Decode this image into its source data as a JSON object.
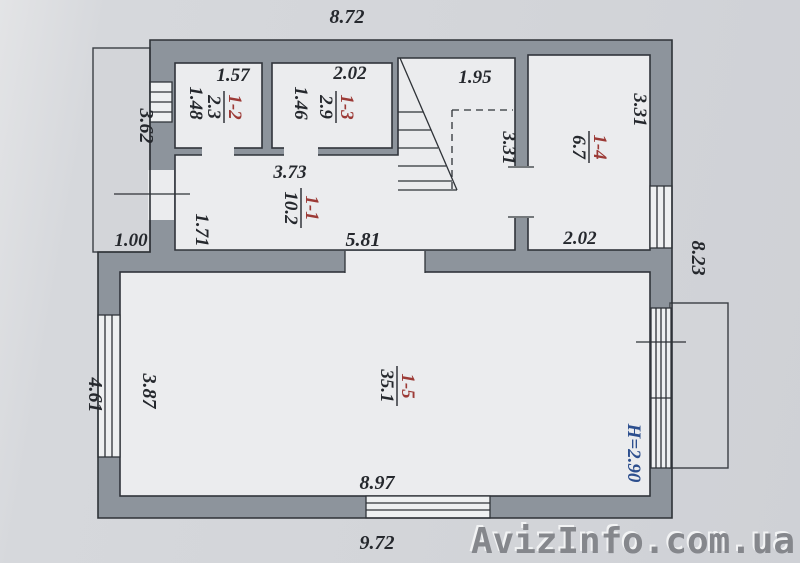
{
  "watermark": "AvizInfo.com.ua",
  "height_label": "H=2.90",
  "rooms": {
    "r11": {
      "num": "1-1",
      "area": "10.2"
    },
    "r12": {
      "num": "1-2",
      "area": "2.3"
    },
    "r13": {
      "num": "1-3",
      "area": "2.9"
    },
    "r14": {
      "num": "1-4",
      "area": "6.7"
    },
    "r15": {
      "num": "1-5",
      "area": "35.1"
    }
  },
  "dims": {
    "top_width": "8.72",
    "r12_width": "1.57",
    "r12_height": "1.48",
    "r13_width": "2.02",
    "r13_height": "1.46",
    "stairs_width": "1.95",
    "stairs_height": "3.31",
    "r14_height": "3.31",
    "r14_width": "2.02",
    "porch_height": "3.62",
    "porch_width": "1.00",
    "hall_width": "3.73",
    "hall_height": "1.71",
    "hall_bottom": "5.81",
    "right_height": "8.23",
    "left_height": "4.61",
    "r15_height": "3.87",
    "r15_width": "8.97",
    "bottom_width": "9.72"
  },
  "colors": {
    "wall": "#8d949c",
    "line": "#2e3237",
    "room_number": "#9c3a36",
    "height_text": "#2d4f8e",
    "background": "#d3d5d9",
    "watermark": "#85878c"
  }
}
